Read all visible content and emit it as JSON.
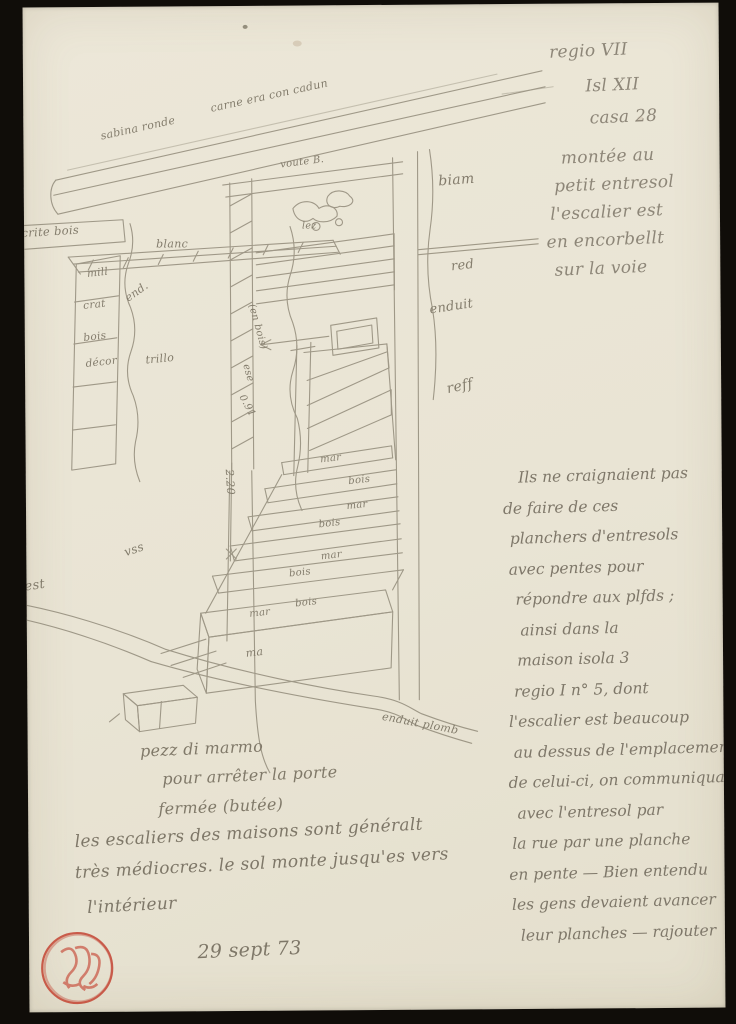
{
  "colors": {
    "scan_background": "#100d09",
    "paper": "#eae5d5",
    "pencil": "#8a8272",
    "stamp_red": "#c23a28"
  },
  "header_notes": {
    "lines": [
      "regio VII",
      "Isl XII",
      "casa 28",
      "montée au",
      "petit entresol",
      "l'escalier est",
      "en encorbellt",
      "sur la voie"
    ]
  },
  "beam": {
    "left_label": "sabina ronde",
    "right_label": "carne era con cadun"
  },
  "door": {
    "vault_label": "voute B.",
    "stones_label": "lez"
  },
  "left_wall": {
    "lintel_label": "écrite bois",
    "pilaster_rows": [
      "mill",
      "crat",
      "bois",
      "décor"
    ],
    "plaster_labels": [
      "blanc",
      "end.",
      "trillo"
    ],
    "floor_label": "vss",
    "edge_label": "fest"
  },
  "jamb": {
    "material_label": "(en bois)",
    "note_label": "ese",
    "dim_height": "0.91",
    "dim_width": "2.20"
  },
  "right_wall": {
    "labels": [
      "biam",
      "red",
      "enduit",
      "reff"
    ]
  },
  "stairs": {
    "step_labels": [
      "mar",
      "bois",
      "mar",
      "bois",
      "mar",
      "bois",
      "bois",
      "mar",
      "ma"
    ],
    "threshold_label": "enduit plomb"
  },
  "captions": {
    "marble_note": {
      "lines": [
        "pezz di marmo",
        "pour arrêter la porte",
        "fermée (butée)"
      ]
    },
    "bottom_note": {
      "lines": [
        "les escaliers des maisons sont généralt",
        "très médiocres. le sol monte jusqu'es vers",
        "l'intérieur"
      ]
    },
    "date": "29 sept 73"
  },
  "side_paragraph": {
    "lines": [
      "Ils ne craignaient pas",
      "de faire de ces",
      "planchers d'entresols",
      "avec pentes pour",
      "répondre aux plfds ;",
      "ainsi dans la",
      "maison  isola 3",
      "regio I   n° 5, dont",
      "l'escalier est beaucoup",
      "au dessus de l'emplacement",
      "de celui-ci, on communiquait",
      "avec l'entresol par",
      "la rue par une planche",
      "en pente — Bien entendu",
      "les gens devaient avancer",
      "leur planches — rajouter"
    ]
  },
  "stamp": {
    "name": "red-collector-stamp"
  }
}
